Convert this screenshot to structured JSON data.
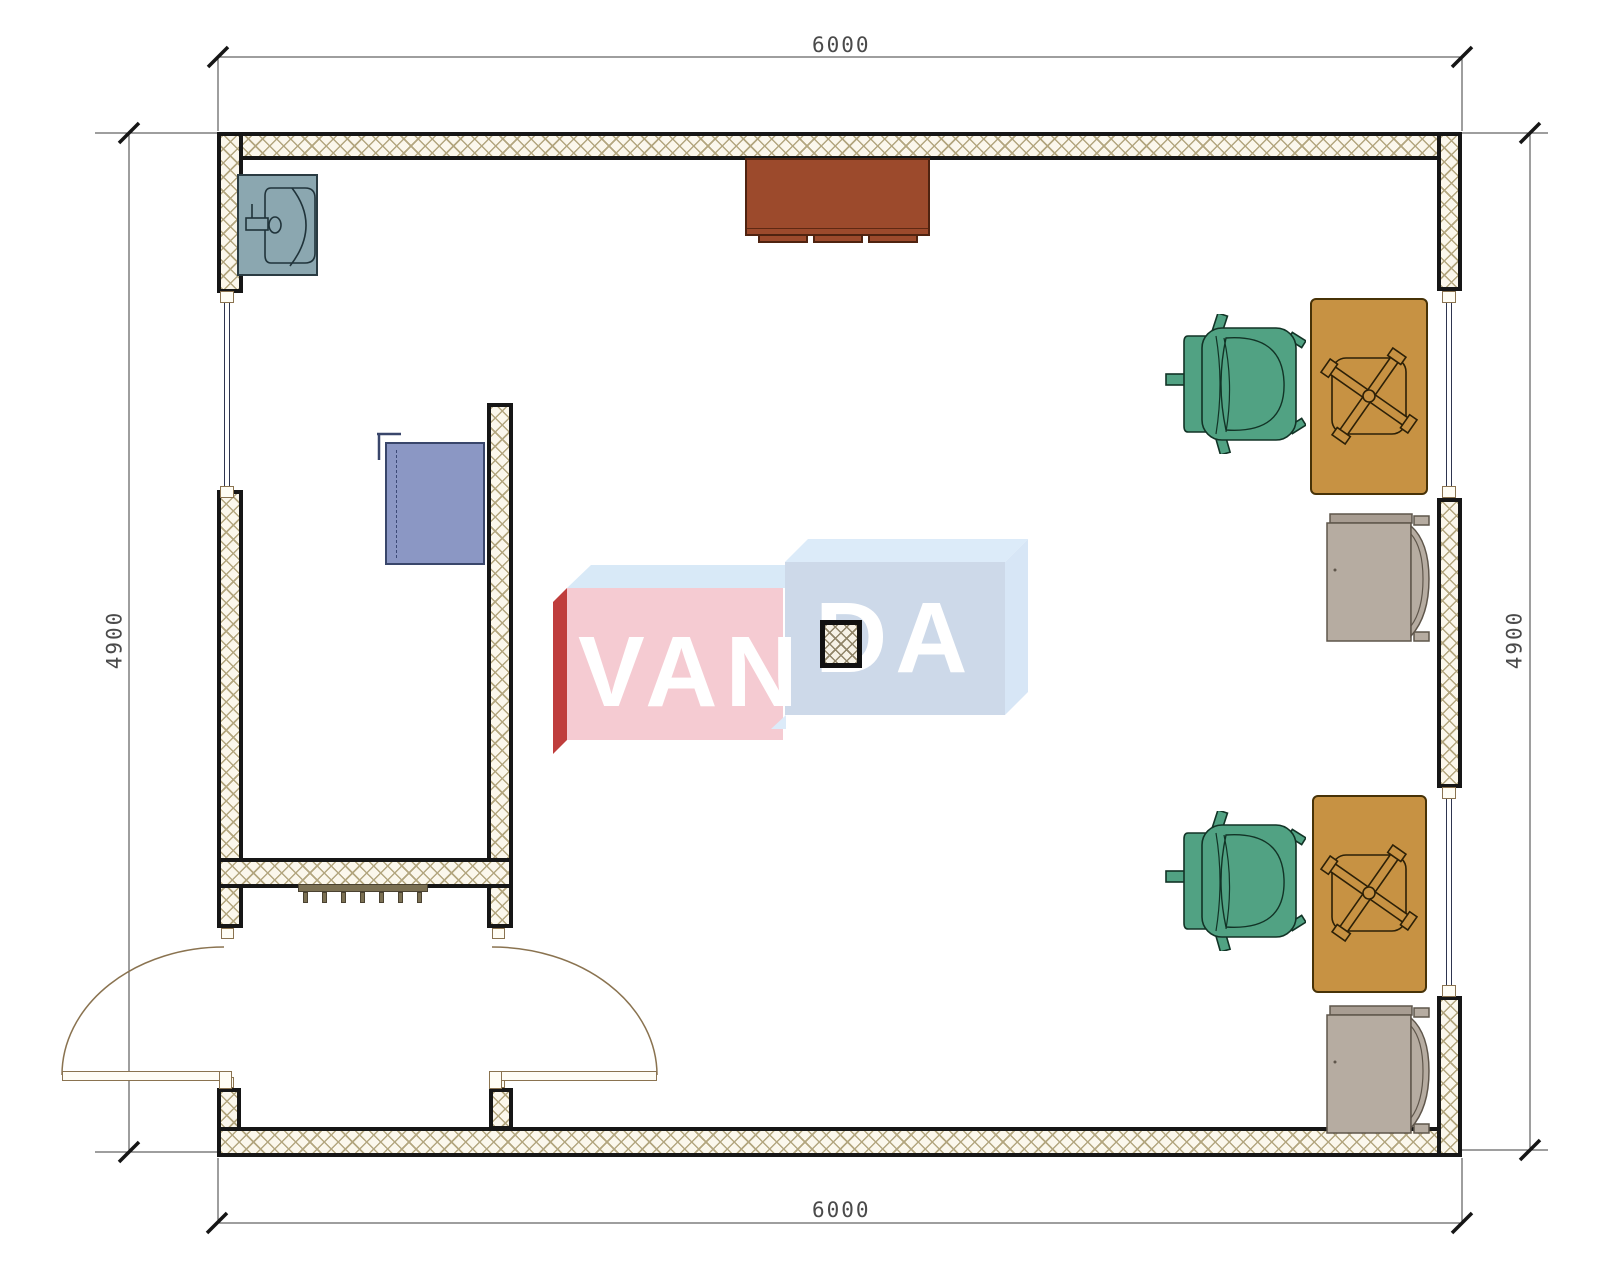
{
  "drawing": {
    "type": "architectural floor plan, top view, single room 6000 x 4900 mm with entry vestibule, two work desks, chairs, sink and cabinets",
    "dimensions": {
      "top": "6000",
      "bottom": "6000",
      "left": "4900",
      "right": "4900"
    },
    "watermark": {
      "left_text": "VAN",
      "right_text": "DA"
    },
    "colors": {
      "wall_hatch": "#b3a67f",
      "wall_line": "#161616",
      "desk": "#c79243",
      "desk_border": "#473207",
      "office_chair_green": "#51a283",
      "side_chair_gray": "#b6aca1",
      "cabinet_brown": "#9c4a2c",
      "cabinet_blue": "#8b97c4",
      "sink": "#8ba7b0",
      "door_line": "#8a7350",
      "window_line": "#2e3550",
      "radiator": "#7b7053",
      "watermark_pink": "#f5cbd2",
      "watermark_red": "#bf3d3c",
      "watermark_blue_front": "#cdd9e9",
      "watermark_blue_top": "#d8e9f7",
      "dimension_text": "#4a4a4a"
    }
  }
}
